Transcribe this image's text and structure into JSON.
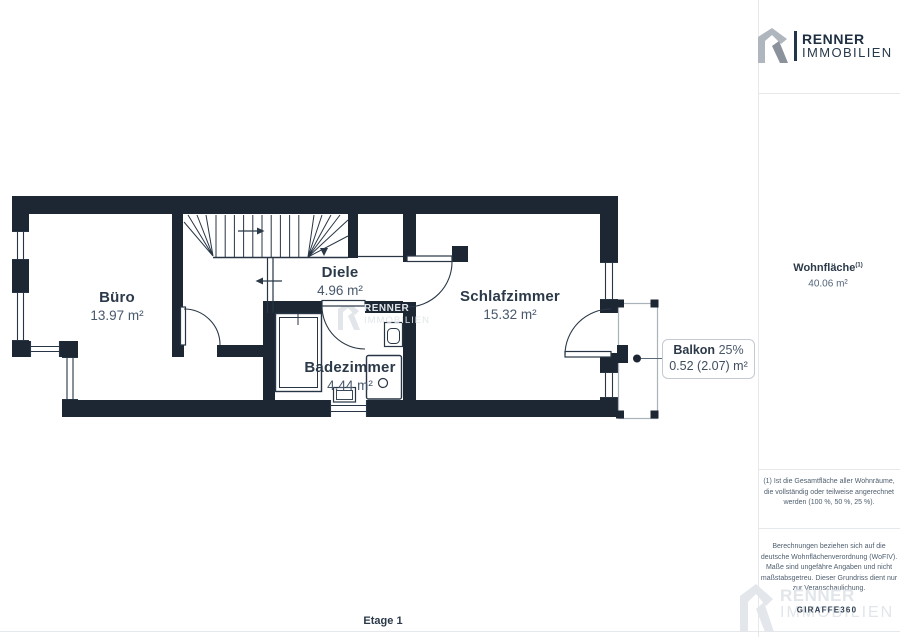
{
  "logo": {
    "name_bold": "RENNER",
    "name_light": "IMMOBILIEN"
  },
  "watermark": {
    "line1": "RENNER",
    "line2": "IMMOBILIEN"
  },
  "floorplan": {
    "rooms": [
      {
        "name": "Büro",
        "area": "13.97 m²"
      },
      {
        "name": "Diele",
        "area": "4.96 m²"
      },
      {
        "name": "Schlafzimmer",
        "area": "15.32 m²"
      },
      {
        "name": "Badezimmer",
        "area": "4.44 m²"
      }
    ],
    "balcony_label": {
      "name": "Balkon",
      "percent": "25%",
      "area": "0.52 (2.07) m²"
    },
    "floor_label": "Etage 1"
  },
  "sidebar": {
    "living_area": {
      "label": "Wohnfläche",
      "superscript": "(1)",
      "value": "40.06 m²"
    },
    "footnote": "(1) Ist die Gesamtfläche aller Wohnräume, die vollständig oder teilweise angerechnet werden (100 %, 50 %, 25 %).",
    "disclaimer": "Berechnungen beziehen sich auf die deutsche Wohnflächenverordnung (WoFIV). Maße sind ungefähre Angaben und nicht maßstabsgetreu. Dieser Grundriss dient nur zur Veranschaulichung.",
    "provider": "GIRAFFE360"
  },
  "colors": {
    "wall": "#1d2734",
    "line": "#273544",
    "label": "#2b3949",
    "value": "#47586b",
    "divider": "#e6e9ec",
    "watermark": "#e2e6ea",
    "balcony_border": "#aab2ba"
  }
}
